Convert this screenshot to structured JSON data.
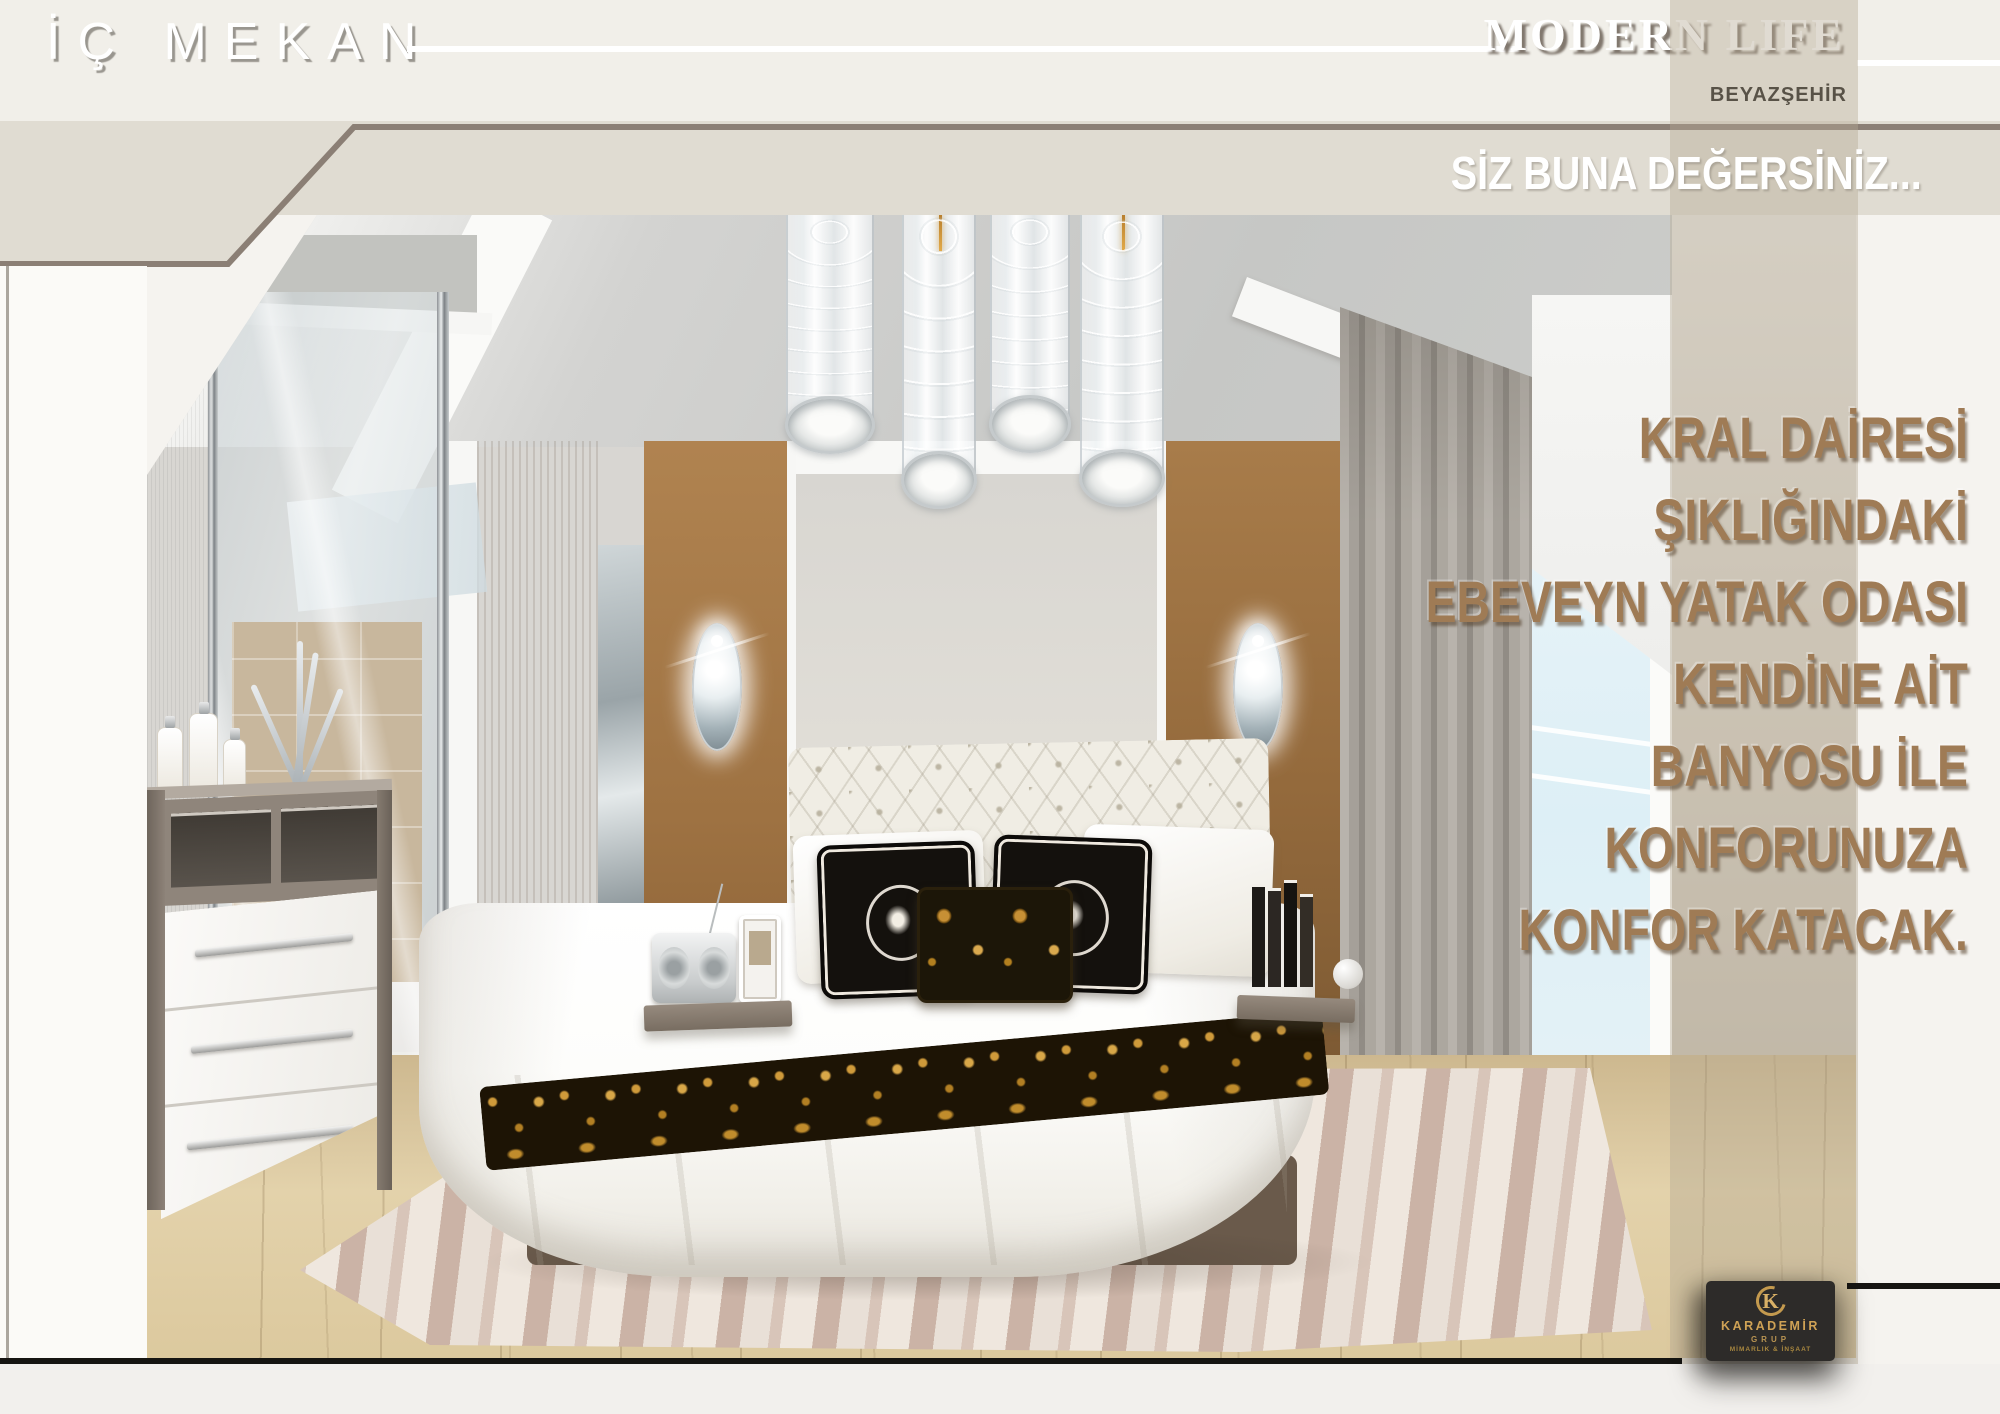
{
  "brand": {
    "title": "İÇ MEKAN"
  },
  "project": {
    "title": "MODERN LIFE",
    "subtitle": "BEYAZŞEHİR"
  },
  "banner": {
    "tagline": "SİZ BUNA DEĞERSİNİZ..."
  },
  "message": {
    "lines": [
      "KRAL DAİRESİ",
      "ŞIKLIĞINDAKİ",
      "EBEVEYN YATAK ODASI",
      "KENDİNE AİT",
      "BANYOSU İLE",
      "KONFORUNUZA",
      "KONFOR KATACAK."
    ]
  },
  "footer": {
    "company": "KARADEMİR",
    "group": "GRUP",
    "tagline": "MİMARLIK & İNŞAAT"
  },
  "colors": {
    "banner_beige": "#e0dcd2",
    "banner_line": "#8b7f75",
    "accent_gold": "#c49a4e",
    "message_brown": "#9f7b55",
    "rule_black": "#161512"
  }
}
